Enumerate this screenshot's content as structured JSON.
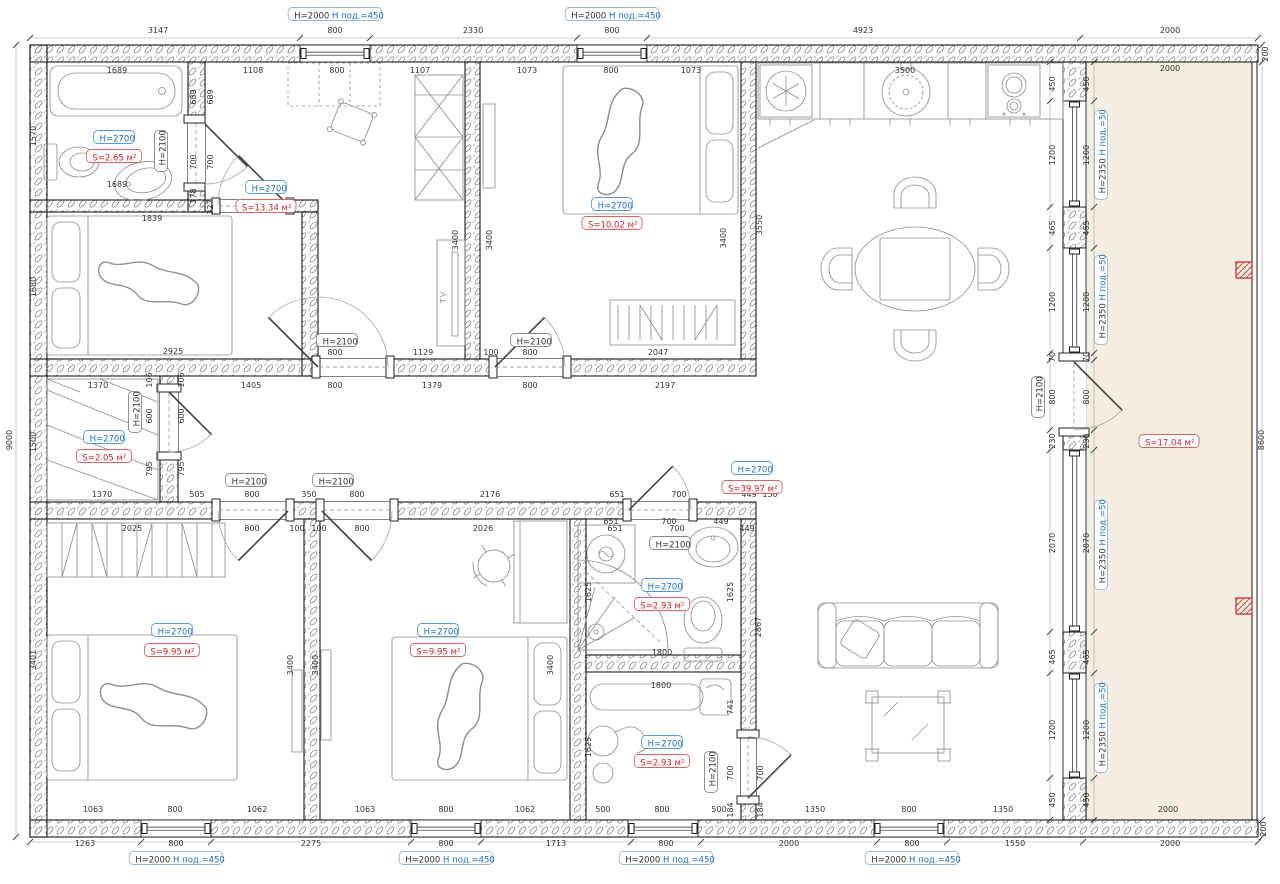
{
  "colors": {
    "dim_text": "#333333",
    "blue": "#1a6fc4",
    "red": "#cc2222",
    "label_black": "#333333",
    "terrace_fill": "#f3ede2",
    "red_marker": "#cc2222",
    "wall": "#1a1a1a"
  },
  "tv_label": "TV",
  "dims": [
    {
      "t": "3147",
      "x": 158,
      "y": 33
    },
    {
      "t": "800",
      "x": 335,
      "y": 33
    },
    {
      "t": "2330",
      "x": 473,
      "y": 33
    },
    {
      "t": "800",
      "x": 612,
      "y": 33
    },
    {
      "t": "4923",
      "x": 863,
      "y": 33
    },
    {
      "t": "2000",
      "x": 1170,
      "y": 33
    },
    {
      "t": "1689",
      "x": 117,
      "y": 73
    },
    {
      "t": "1108",
      "x": 253,
      "y": 73
    },
    {
      "t": "800",
      "x": 337,
      "y": 73
    },
    {
      "t": "1107",
      "x": 420,
      "y": 73
    },
    {
      "t": "1073",
      "x": 527,
      "y": 73
    },
    {
      "t": "800",
      "x": 611,
      "y": 73
    },
    {
      "t": "1073",
      "x": 691,
      "y": 73
    },
    {
      "t": "3500",
      "x": 905,
      "y": 73
    },
    {
      "t": "2000",
      "x": 1170,
      "y": 71
    },
    {
      "t": "200",
      "x": 1268,
      "y": 54,
      "v": 1
    },
    {
      "t": "8600",
      "x": 1264,
      "y": 440,
      "v": 1
    },
    {
      "t": "200",
      "x": 1266,
      "y": 829,
      "v": 1
    },
    {
      "t": "450",
      "x": 1055,
      "y": 84,
      "v": 1
    },
    {
      "t": "450",
      "x": 1089,
      "y": 84,
      "v": 1
    },
    {
      "t": "1200",
      "x": 1055,
      "y": 155,
      "v": 1
    },
    {
      "t": "1200",
      "x": 1089,
      "y": 155,
      "v": 1
    },
    {
      "t": "465",
      "x": 1055,
      "y": 228,
      "v": 1
    },
    {
      "t": "465",
      "x": 1089,
      "y": 228,
      "v": 1
    },
    {
      "t": "1200",
      "x": 1055,
      "y": 302,
      "v": 1
    },
    {
      "t": "1200",
      "x": 1089,
      "y": 302,
      "v": 1
    },
    {
      "t": "70",
      "x": 1055,
      "y": 357,
      "v": 1
    },
    {
      "t": "70",
      "x": 1089,
      "y": 357,
      "v": 1
    },
    {
      "t": "800",
      "x": 1055,
      "y": 397,
      "v": 1
    },
    {
      "t": "800",
      "x": 1089,
      "y": 397,
      "v": 1
    },
    {
      "t": "230",
      "x": 1055,
      "y": 441,
      "v": 1
    },
    {
      "t": "230",
      "x": 1089,
      "y": 441,
      "v": 1
    },
    {
      "t": "2070",
      "x": 1055,
      "y": 543,
      "v": 1
    },
    {
      "t": "2070",
      "x": 1089,
      "y": 543,
      "v": 1
    },
    {
      "t": "465",
      "x": 1055,
      "y": 657,
      "v": 1
    },
    {
      "t": "465",
      "x": 1089,
      "y": 657,
      "v": 1
    },
    {
      "t": "1200",
      "x": 1055,
      "y": 730,
      "v": 1
    },
    {
      "t": "1200",
      "x": 1089,
      "y": 730,
      "v": 1
    },
    {
      "t": "450",
      "x": 1055,
      "y": 800,
      "v": 1
    },
    {
      "t": "450",
      "x": 1089,
      "y": 800,
      "v": 1
    },
    {
      "t": "9000",
      "x": 12,
      "y": 440,
      "v": 1
    },
    {
      "t": "1570",
      "x": 36,
      "y": 136,
      "v": 1
    },
    {
      "t": "1680",
      "x": 36,
      "y": 287,
      "v": 1
    },
    {
      "t": "1500",
      "x": 36,
      "y": 442,
      "v": 1
    },
    {
      "t": "3401",
      "x": 36,
      "y": 660,
      "v": 1
    },
    {
      "t": "689",
      "x": 196,
      "y": 97,
      "v": 1
    },
    {
      "t": "689",
      "x": 213,
      "y": 97,
      "v": 1
    },
    {
      "t": "700",
      "x": 196,
      "y": 162,
      "v": 1
    },
    {
      "t": "700",
      "x": 213,
      "y": 162,
      "v": 1
    },
    {
      "t": "178",
      "x": 196,
      "y": 196,
      "v": 1
    },
    {
      "t": "327",
      "x": 213,
      "y": 207,
      "v": 1
    },
    {
      "t": "1689",
      "x": 117,
      "y": 187
    },
    {
      "t": "1839",
      "x": 152,
      "y": 221
    },
    {
      "t": "2925",
      "x": 173,
      "y": 354
    },
    {
      "t": "800",
      "x": 335,
      "y": 355
    },
    {
      "t": "1129",
      "x": 423,
      "y": 355
    },
    {
      "t": "100",
      "x": 491,
      "y": 355
    },
    {
      "t": "800",
      "x": 530,
      "y": 355
    },
    {
      "t": "2047",
      "x": 658,
      "y": 355
    },
    {
      "t": "1370",
      "x": 98,
      "y": 388
    },
    {
      "t": "1405",
      "x": 251,
      "y": 388
    },
    {
      "t": "800",
      "x": 335,
      "y": 388
    },
    {
      "t": "1379",
      "x": 432,
      "y": 388
    },
    {
      "t": "800",
      "x": 530,
      "y": 388
    },
    {
      "t": "2197",
      "x": 665,
      "y": 388
    },
    {
      "t": "106",
      "x": 152,
      "y": 380,
      "v": 1
    },
    {
      "t": "106",
      "x": 184,
      "y": 380,
      "v": 1
    },
    {
      "t": "3400",
      "x": 458,
      "y": 240,
      "v": 1
    },
    {
      "t": "3400",
      "x": 492,
      "y": 240,
      "v": 1
    },
    {
      "t": "3400",
      "x": 726,
      "y": 238,
      "v": 1
    },
    {
      "t": "3550",
      "x": 762,
      "y": 225,
      "v": 1
    },
    {
      "t": "600",
      "x": 152,
      "y": 416,
      "v": 1
    },
    {
      "t": "600",
      "x": 184,
      "y": 416,
      "v": 1
    },
    {
      "t": "795",
      "x": 152,
      "y": 469,
      "v": 1
    },
    {
      "t": "795",
      "x": 184,
      "y": 469,
      "v": 1
    },
    {
      "t": "1370",
      "x": 102,
      "y": 497
    },
    {
      "t": "505",
      "x": 197,
      "y": 497
    },
    {
      "t": "800",
      "x": 252,
      "y": 497
    },
    {
      "t": "350",
      "x": 309,
      "y": 497
    },
    {
      "t": "800",
      "x": 357,
      "y": 497
    },
    {
      "t": "2176",
      "x": 490,
      "y": 497
    },
    {
      "t": "651",
      "x": 617,
      "y": 497
    },
    {
      "t": "700",
      "x": 679,
      "y": 497
    },
    {
      "t": "449",
      "x": 749,
      "y": 497
    },
    {
      "t": "150",
      "x": 770,
      "y": 497
    },
    {
      "t": "800",
      "x": 252,
      "y": 531
    },
    {
      "t": "100",
      "x": 297,
      "y": 531
    },
    {
      "t": "100",
      "x": 319,
      "y": 531
    },
    {
      "t": "800",
      "x": 362,
      "y": 531
    },
    {
      "t": "2026",
      "x": 483,
      "y": 531
    },
    {
      "t": "651",
      "x": 615,
      "y": 531
    },
    {
      "t": "700",
      "x": 677,
      "y": 531
    },
    {
      "t": "449",
      "x": 747,
      "y": 531
    },
    {
      "t": "2025",
      "x": 132,
      "y": 531
    },
    {
      "t": "3400",
      "x": 293,
      "y": 665,
      "v": 1
    },
    {
      "t": "3400",
      "x": 318,
      "y": 665,
      "v": 1
    },
    {
      "t": "3400",
      "x": 553,
      "y": 665,
      "v": 1
    },
    {
      "t": "651",
      "x": 611,
      "y": 524
    },
    {
      "t": "700",
      "x": 669,
      "y": 524
    },
    {
      "t": "449",
      "x": 721,
      "y": 524
    },
    {
      "t": "1625",
      "x": 591,
      "y": 592,
      "v": 1
    },
    {
      "t": "1625",
      "x": 733,
      "y": 592,
      "v": 1
    },
    {
      "t": "1800",
      "x": 662,
      "y": 655
    },
    {
      "t": "2867",
      "x": 761,
      "y": 627,
      "v": 1
    },
    {
      "t": "1800",
      "x": 661,
      "y": 688
    },
    {
      "t": "741",
      "x": 733,
      "y": 707,
      "v": 1
    },
    {
      "t": "1625",
      "x": 591,
      "y": 747,
      "v": 1
    },
    {
      "t": "700",
      "x": 733,
      "y": 773,
      "v": 1
    },
    {
      "t": "700",
      "x": 763,
      "y": 773,
      "v": 1
    },
    {
      "t": "184",
      "x": 733,
      "y": 810,
      "v": 1
    },
    {
      "t": "184",
      "x": 763,
      "y": 810,
      "v": 1
    },
    {
      "t": "500",
      "x": 603,
      "y": 812
    },
    {
      "t": "800",
      "x": 662,
      "y": 812
    },
    {
      "t": "500",
      "x": 719,
      "y": 812
    },
    {
      "t": "1063",
      "x": 93,
      "y": 812
    },
    {
      "t": "800",
      "x": 175,
      "y": 812
    },
    {
      "t": "1062",
      "x": 257,
      "y": 812
    },
    {
      "t": "1063",
      "x": 365,
      "y": 812
    },
    {
      "t": "800",
      "x": 446,
      "y": 812
    },
    {
      "t": "1062",
      "x": 525,
      "y": 812
    },
    {
      "t": "1350",
      "x": 815,
      "y": 812
    },
    {
      "t": "800",
      "x": 909,
      "y": 812
    },
    {
      "t": "1350",
      "x": 1003,
      "y": 812
    },
    {
      "t": "1263",
      "x": 85,
      "y": 846
    },
    {
      "t": "800",
      "x": 176,
      "y": 846
    },
    {
      "t": "2275",
      "x": 311,
      "y": 846
    },
    {
      "t": "800",
      "x": 446,
      "y": 846
    },
    {
      "t": "1713",
      "x": 556,
      "y": 846
    },
    {
      "t": "800",
      "x": 666,
      "y": 846
    },
    {
      "t": "2000",
      "x": 789,
      "y": 846
    },
    {
      "t": "800",
      "x": 912,
      "y": 846
    },
    {
      "t": "1550",
      "x": 1015,
      "y": 846
    },
    {
      "t": "2000",
      "x": 1170,
      "y": 846
    },
    {
      "t": "2000",
      "x": 1168,
      "y": 812
    }
  ],
  "door_labels": [
    {
      "t": "H=2100",
      "x": 163,
      "y": 151,
      "v": 1
    },
    {
      "t": "H=2100",
      "x": 137,
      "y": 412,
      "v": 1
    },
    {
      "t": "H=2100",
      "x": 337,
      "y": 342
    },
    {
      "t": "H=2100",
      "x": 531,
      "y": 342
    },
    {
      "t": "H=2100",
      "x": 246,
      "y": 482
    },
    {
      "t": "H=2100",
      "x": 333,
      "y": 482
    },
    {
      "t": "H=2100",
      "x": 670,
      "y": 545
    },
    {
      "t": "H=2100",
      "x": 713,
      "y": 772,
      "v": 1
    },
    {
      "t": "H=2100",
      "x": 1040,
      "y": 397,
      "v": 1
    }
  ],
  "room_labels": [
    {
      "h": "H=2700",
      "s": "S=2.65 м²",
      "x": 114,
      "hy": 139,
      "sy": 158
    },
    {
      "h": "H=2700",
      "s": "S=13.34 м²",
      "x": 266,
      "hy": 189,
      "sy": 208
    },
    {
      "h": "H=2700",
      "s": "S=10.02 м²",
      "x": 612,
      "hy": 206,
      "sy": 225
    },
    {
      "h": "H=2700",
      "s": "S=2.05 м²",
      "x": 104,
      "hy": 439,
      "sy": 458
    },
    {
      "h": "H=2700",
      "s": "S=39.97 м²",
      "x": 752,
      "hy": 470,
      "sy": 489
    },
    {
      "h": "H=2700",
      "s": "S=9.95 м²",
      "x": 172,
      "hy": 632,
      "sy": 652
    },
    {
      "h": "H=2700",
      "s": "S=9.95 м²",
      "x": 438,
      "hy": 632,
      "sy": 652
    },
    {
      "h": "H=2700",
      "s": "S=2.93 м²",
      "x": 662,
      "hy": 587,
      "sy": 606
    },
    {
      "h": "H=2700",
      "s": "S=2.93 м²",
      "x": 662,
      "hy": 744,
      "sy": 763
    },
    {
      "s": "S=17.04 м²",
      "x": 1169,
      "sy": 443
    }
  ],
  "window_labels": [
    {
      "a": "H=2000",
      "b": "Н под.=450",
      "x": 335,
      "y": 16
    },
    {
      "a": "H=2000",
      "b": "Н под.=450",
      "x": 612,
      "y": 16
    },
    {
      "a": "H=2000",
      "b": "Н под.=450",
      "x": 176,
      "y": 860
    },
    {
      "a": "H=2000",
      "b": "Н под.=450",
      "x": 446,
      "y": 860
    },
    {
      "a": "H=2000",
      "b": "Н под.=450",
      "x": 666,
      "y": 860
    },
    {
      "a": "H=2000",
      "b": "Н под.=450",
      "x": 912,
      "y": 860
    }
  ],
  "terrace_window_labels": [
    {
      "a": "H=2350",
      "b": "Н под.=50",
      "x": 1103,
      "y": 155,
      "v": 1
    },
    {
      "a": "H=2350",
      "b": "Н под.=50",
      "x": 1103,
      "y": 300,
      "v": 1
    },
    {
      "a": "H=2350",
      "b": "Н под.=50",
      "x": 1103,
      "y": 545,
      "v": 1
    },
    {
      "a": "H=2350",
      "b": "Н под.=50",
      "x": 1103,
      "y": 728,
      "v": 1
    }
  ]
}
